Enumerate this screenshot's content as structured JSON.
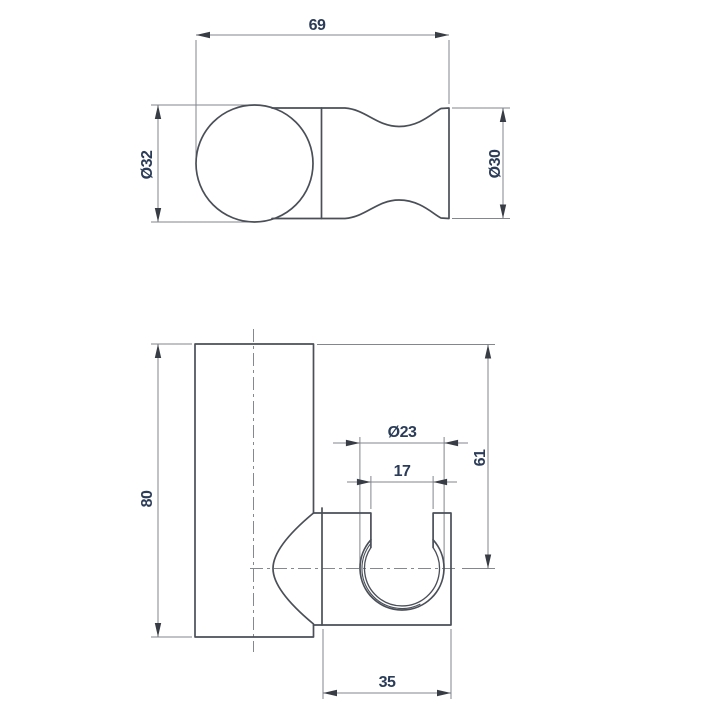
{
  "drawing": {
    "type": "technical-dimension-drawing",
    "colors": {
      "outline": "#4a4f58",
      "dimension_lines": "#82868d",
      "centerline": "#85898f",
      "dimension_text": "#2b3c58",
      "background": "#ffffff"
    },
    "views": {
      "top": {
        "label": "top view",
        "dimensions": {
          "overall_length": {
            "label": "69"
          },
          "knob_diameter": {
            "label": "Ø32"
          },
          "cradle_diameter": {
            "label": "Ø30"
          }
        }
      },
      "front": {
        "label": "front view",
        "dimensions": {
          "plate_height": {
            "label": "80"
          },
          "channel_diameter": {
            "label": "Ø23"
          },
          "opening_width": {
            "label": "17"
          },
          "cradle_center_offset": {
            "label": "61"
          },
          "body_width": {
            "label": "35"
          }
        }
      }
    }
  }
}
